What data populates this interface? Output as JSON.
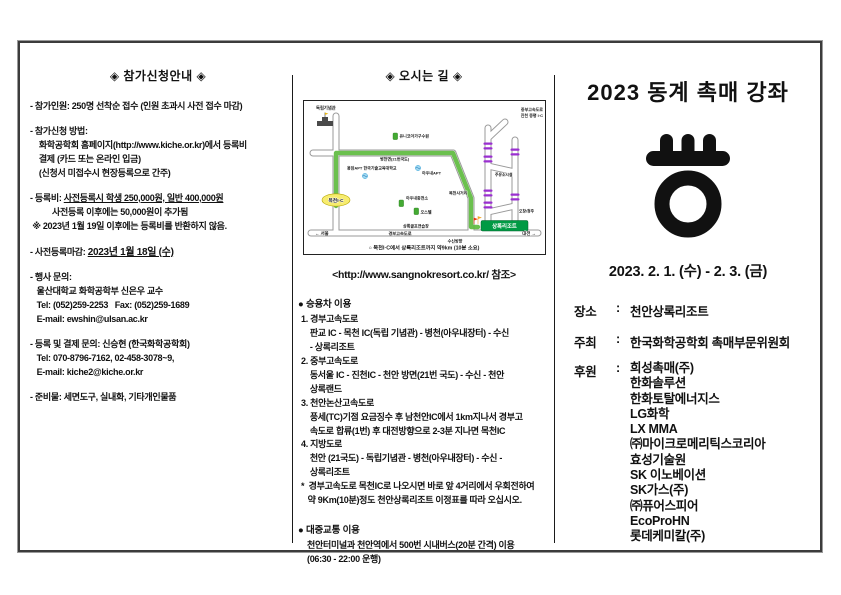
{
  "theme": {
    "route_green": "#5ebb3f",
    "marker_purple": "#9a2fd0",
    "resort_green": "#009a44",
    "ic_yellow": "#f7ec6e",
    "ink": "#111111"
  },
  "left": {
    "header": "◈ 참가신청안내 ◈",
    "p_capacity": "- 참가인원: 250명 선착순 접수 (인원 초과시 사전 접수 마감)",
    "p_method": "- 참가신청 방법:\n    화학공학회 홈페이지(http://www.kiche.or.kr)에서 등록비\n    결제 (카드 또는 온라인 입금)\n    (신청서 미접수시 현장등록으로 간주)",
    "fee_prefix": "- 등록비: ",
    "fee_underlined": "사전등록시 학생 250,000원, 일반 400,000원",
    "fee_rest": "\n          사전등록 이후에는 50,000원이 추가됨\n ※ 2023년 1월 19일 이후에는 등록비를 반환하지 않음.",
    "deadline_prefix": "- 사전등록마감: ",
    "deadline_value": "2023년 1월 18일 (수)",
    "p_event_contact": "- 행사 문의:\n   울산대학교 화학공학부 신은우 교수\n   Tel: (052)259-2253   Fax: (052)259-1689\n   E-mail: ewshin@ulsan.ac.kr",
    "p_reg_contact": "- 등록 및 결제 문의: 신승현 (한국화학공학회)\n   Tel: 070-8796-7162, 02-458-3078~9,\n   E-mail: kiche2@kiche.or.kr",
    "p_supplies": "- 준비물: 세면도구, 실내화, 기타개인물품"
  },
  "middle": {
    "header": "◈ 오시는 길 ◈",
    "map": {
      "labels": {
        "independence_hall": "독립기념관",
        "unicoa": "유니코아가구수원",
        "byeongcheon": "병천면(21번국도)",
        "apt_school": "용암APT 한국기술교육대학교",
        "awunae_apt": "아우내APT",
        "mokcheon_crossroad": "목천사거리",
        "awunae_station": "아우내충전소",
        "ostel": "오스텔",
        "golf_range": "상록골프연습장",
        "resort": "상록리조트",
        "mokcheon_ic": "목천I·C",
        "jungbu_expressway": "중부고속도로",
        "jincheon_ic": "진천 증평 I·C",
        "gas_station": "주유소시설",
        "ochang": "오창/청주",
        "seoul": "← 서울",
        "gyeongbu": "경부고속도로",
        "susin": "수신방향",
        "daejeon": "대전 →",
        "caption": "○ 목천I·C에서 상록리조트까지 약9km (10분 소요)"
      }
    },
    "link": "<http://www.sangnokresort.co.kr/ 참조>",
    "car_header": "● 승용차 이용",
    "car_text": "1. 경부고속도로\n    판교 IC - 목천 IC(독립 기념관) - 병천(아우내장터) - 수신\n    - 상록리조트\n2. 중부고속도로\n    동서울 IC - 진천IC - 천안 방면(21번 국도) - 수신 - 천안\n    상록랜드\n3. 천안논산고속도로\n    풍세(TC)기점 요금징수 후 남천안IC에서 1km지나서 경부고\n    속도로 합류(1번) 후 대전방향으로 2-3분 지나면 목천IC\n4. 지방도로\n    천안 (21국도) - 독립기념관 - 병천(아우내장터) - 수신 -\n    상록리조트\n*  경부고속도로 목천IC로 나오시면 바로 앞 4거리에서 우회전하여\n   약 9Km(10분)정도 천안상록리조트 이정표를 따라 오십시오.",
    "transit_header": "● 대중교통 이용",
    "transit_text": "천안터미널과 천안역에서 500번 시내버스(20분 간격) 이용\n(06:30 - 22:00 운행)"
  },
  "right": {
    "title": "2023 동계 촉매 강좌",
    "date_range": "2023. 2. 1. (수) - 2. 3. (금)",
    "venue_label": "장소",
    "colon": ":",
    "venue": "천안상록리조트",
    "host_label": "주최",
    "host": "한국화학공학회 촉매부문위원회",
    "sponsor_label": "후원",
    "sponsors": [
      "희성촉매(주)",
      "한화솔루션",
      "한화토탈에너지스",
      "LG화학",
      "LX MMA",
      "㈜마이크로메리틱스코리아",
      "효성기술원",
      "SK 이노베이션",
      "SK가스(주)",
      "㈜퓨어스피어",
      "EcoProHN",
      "롯데케미칼(주)"
    ]
  }
}
